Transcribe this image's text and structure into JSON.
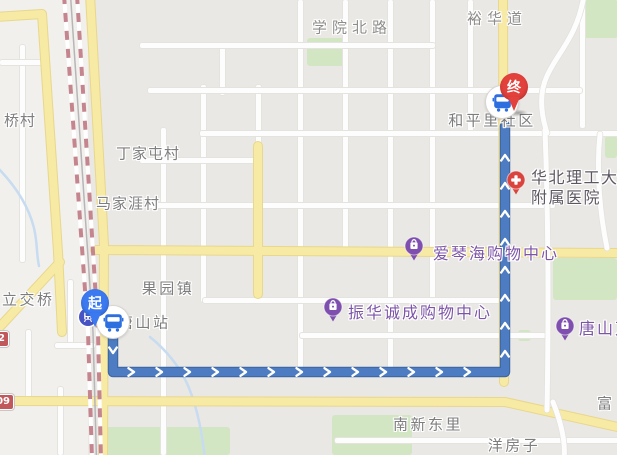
{
  "map": {
    "type": "route-map",
    "colors": {
      "land": "#eae8e4",
      "land_light": "#f1f0ed",
      "road_white": "#fdfdfd",
      "road_yellow": "#f7eaa5",
      "road_yellow_casing": "#e8d78c",
      "park": "#d3e6c4",
      "water": "#c7dcf0",
      "railway": "#c4858e",
      "route": "#4d7cc2",
      "route_casing": "#3e68a6",
      "pin_start": "#3b79f0",
      "pin_end": "#e2413c",
      "pin_shopping": "#7e4fae",
      "pin_hospital": "#d9453e",
      "bus_icon_color": "#2e6fe0",
      "shield": "#c0585c"
    },
    "icons": [
      "bus-icon",
      "train-station-icon",
      "shopping-bag-icon",
      "hospital-cross-icon",
      "route-chevron-icon"
    ],
    "labels": [
      {
        "id": "xueyuan-north-road",
        "text": "学院北路",
        "type": "road",
        "x": 352,
        "y": 27
      },
      {
        "id": "yuhua-road",
        "text": "裕华道",
        "type": "road",
        "x": 497,
        "y": 18
      },
      {
        "id": "qiao-village",
        "text": "桥村",
        "type": "town",
        "x": 20,
        "y": 120
      },
      {
        "id": "dingjiatun-village",
        "text": "丁家屯村",
        "type": "town",
        "x": 148,
        "y": 153
      },
      {
        "id": "majiaya-village",
        "text": "马家涯村",
        "type": "town",
        "x": 128,
        "y": 203
      },
      {
        "id": "hepingli-community",
        "text": "和平里社区",
        "type": "big",
        "x": 492,
        "y": 120
      },
      {
        "id": "hospital-name-line1",
        "text": "华北理工大学",
        "type": "hospital",
        "x": 531,
        "y": 176,
        "align": "left"
      },
      {
        "id": "hospital-name-line2",
        "text": "附属医院",
        "type": "hospital",
        "x": 531,
        "y": 196,
        "align": "left"
      },
      {
        "id": "aiqinhai-mall",
        "text": "爱琴海购物中心",
        "type": "shopping",
        "x": 433,
        "y": 252,
        "align": "left",
        "interactable": true
      },
      {
        "id": "zhenhua-mall",
        "text": "振华诚成购物中心",
        "type": "shopping",
        "x": 348,
        "y": 311,
        "align": "left",
        "interactable": true
      },
      {
        "id": "tangshan-mall",
        "text": "唐山万",
        "type": "shopping",
        "x": 579,
        "y": 327,
        "align": "left",
        "interactable": true
      },
      {
        "id": "guoyuan-town",
        "text": "果园镇",
        "type": "big",
        "x": 168,
        "y": 288
      },
      {
        "id": "tangshan-station",
        "text": "唐山站",
        "type": "big",
        "x": 118,
        "y": 322,
        "align": "left"
      },
      {
        "id": "lijiaoqiao",
        "text": "立交桥",
        "type": "big",
        "x": 2,
        "y": 299,
        "align": "left"
      },
      {
        "id": "nanxin-dongli",
        "text": "南新东里",
        "type": "big",
        "x": 428,
        "y": 424
      },
      {
        "id": "yangfangzi",
        "text": "洋房子",
        "type": "big",
        "x": 514,
        "y": 445
      },
      {
        "id": "fu-village",
        "text": "富",
        "type": "town",
        "x": 597,
        "y": 403,
        "align": "left"
      }
    ],
    "pois": [
      {
        "id": "hospital-pin",
        "kind": "hospital",
        "x": 516,
        "y": 180
      },
      {
        "id": "aiqinhai-pin",
        "kind": "shopping",
        "x": 414,
        "y": 246
      },
      {
        "id": "zhenhua-pin",
        "kind": "shopping",
        "x": 333,
        "y": 307
      },
      {
        "id": "tangshan-pin",
        "kind": "shopping",
        "x": 565,
        "y": 326
      }
    ],
    "route": {
      "points": [
        [
          113,
          332
        ],
        [
          113,
          372
        ],
        [
          505,
          372
        ],
        [
          505,
          126
        ]
      ],
      "chevron_spacing": 28
    },
    "markers": {
      "start": {
        "label": "起",
        "x": 95,
        "y": 303,
        "bus_x": 113,
        "bus_y": 322,
        "station_icon_x": 88,
        "station_icon_y": 317
      },
      "end": {
        "label": "终",
        "x": 514,
        "y": 87,
        "bus_x": 502,
        "bus_y": 102,
        "shadow_x": 519,
        "shadow_y": 113
      }
    },
    "shields": [
      {
        "text": "2",
        "y": 331
      },
      {
        "text": "09",
        "y": 394
      }
    ]
  }
}
